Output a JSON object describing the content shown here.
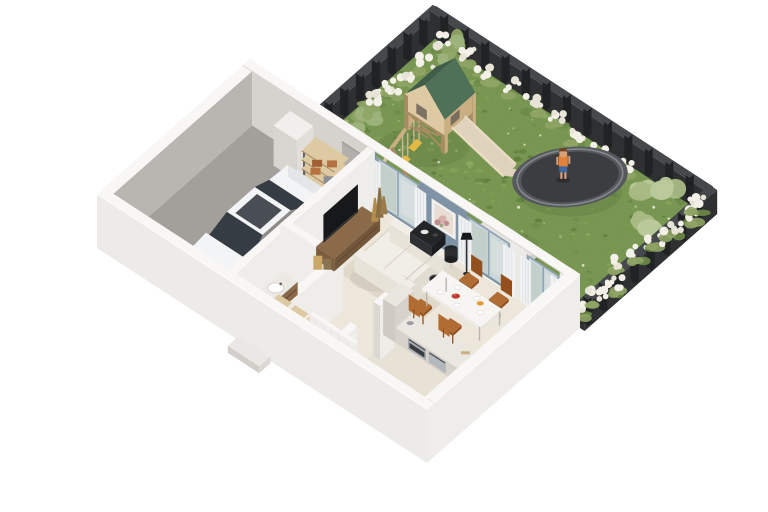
{
  "scene": {
    "type": "isometric-3d-floor-plan",
    "house": {
      "rooms": [
        "garage",
        "bathroom",
        "hallway",
        "staircase",
        "kitchen",
        "dining-area",
        "living-room"
      ],
      "objects": [
        "white-car",
        "storage-shelf",
        "tall-cabinet",
        "garage-door",
        "entry-door",
        "vanity-sink",
        "toilet",
        "closet-shelves",
        "stairs",
        "kitchen-counter",
        "oven",
        "dishwasher",
        "cooktop",
        "dining-table",
        "four-wooden-chairs",
        "tv-stand",
        "tv",
        "sofa",
        "coffee-table",
        "side-table",
        "floor-lamp",
        "robot-vacuum",
        "rug",
        "decor-vases",
        "framed-artwork",
        "curtains",
        "sliding-glass-doors",
        "porch-step"
      ]
    },
    "garden": {
      "objects": [
        "lawn",
        "dark-fence",
        "white-flower-hedges",
        "olive-grasses",
        "light-green-bushes",
        "wooden-swing-set",
        "green-gable-roof",
        "slide",
        "two-yellow-swings",
        "trampoline",
        "child-on-trampoline",
        "concrete-bench-set"
      ]
    }
  },
  "labels": {
    "plot": "3D cutaway floor plan of a single family house with garden",
    "garden_lawn": "green lawn",
    "fence_nw": "dark garden fence rear left",
    "fence_ne": "dark garden fence rear right",
    "fence_se": "dark garden fence front right",
    "flowers": "white flowering hedges along fence",
    "swing_set": "wooden play tower with green roof, slide and swings",
    "trampoline": "round dark trampoline",
    "child": "child standing on trampoline",
    "garden_bench": "concrete garden bench set",
    "floors": "house floors",
    "wall_nw": "rear left exterior wall",
    "wall_ne": "window wall facing garden with blue accent panel",
    "partitions": "interior partition walls",
    "garage_storage": "tall cabinet and storage rack in garage",
    "car": "white coupe parked in garage",
    "bathroom": "bathroom with wooden vanity and toilet",
    "hallway": "hallway closets",
    "stairs": "wooden staircase",
    "kitchen": "kitchen counters with steel appliances",
    "dining": "white dining table with four wooden chairs",
    "living": "living room with white sofa and TV wall",
    "wall_se": "front right exterior wall",
    "wall_sw": "front left exterior wall with garage and entry doors",
    "porch": "entry porch step"
  },
  "colors": {
    "background": "#ffffff",
    "grassBase": "#71904a",
    "grassLight": "#85a457",
    "grassDark": "#5b793a",
    "grassMoss": "#93ad62",
    "flowerWhite": "#f3f1e7",
    "flowerCream": "#e7e4d7",
    "bushGreen": "#8fa465",
    "bushLight": "#bac99b",
    "bushOlive": "#9db37c",
    "foliageDark": "#6d8a49",
    "soil": "#6f5a3c",
    "fenceDark": "#2e3032",
    "fenceTop": "#46494c",
    "fencePost": "#202224",
    "woodLight": "#ddc9a2",
    "wood": "#c9af82",
    "woodDark": "#a78c62",
    "roofGreen": "#4e7158",
    "roofGreenDark": "#3f5d49",
    "slideBeige": "#e0d3bc",
    "slideEdge": "#eadbc4",
    "swingYellow": "#e3b945",
    "trampMat": "#3b3d40",
    "trampPad": "#55585c",
    "trampRim": "#84888c",
    "trampLeg": "#292b2d",
    "childSkin": "#d9a078",
    "childShirt": "#e2813b",
    "childShorts": "#41699f",
    "childHair": "#6f4526",
    "concrete": "#e4e2dc",
    "concreteShade": "#cfcdc6",
    "wallTop": "#f8f7f5",
    "wallLight": "#efedea",
    "wallShade": "#dbd8d3",
    "wallGray": "#b9b5b0",
    "wallMid": "#d6d3ce",
    "accentBlue": "#7e93a6",
    "frameBlue": "#8fa3b3",
    "glass": "#ccd7da",
    "glassGreen": "#b9c9bd",
    "curtain": "#f2f3f4",
    "curtainShade": "#dde0e2",
    "floorMain": "#ece6db",
    "floorWarm": "#e7e0d3",
    "rug": "#e0d9ca",
    "garageFloor": "#a3a09c",
    "garageFloorDark": "#8b8884",
    "bathTile": "#b7babb",
    "bathTileLine": "#a6a9aa",
    "doorDark": "#323437",
    "doorSlat": "#44474b",
    "carWhite": "#f3f4f5",
    "carShade": "#dddfe2",
    "carGlass": "#363c44",
    "carDark": "#222528",
    "carHub": "#787c80",
    "carGrille": "#2e3134",
    "tvBlack": "#17181a",
    "consoleWood": "#8a6a48",
    "consoleWoodDark": "#73573a",
    "sofa": "#f1eee7",
    "sofaShade": "#e1dcd1",
    "tableBlack": "#232527",
    "tableWhite": "#f6f5f2",
    "chairWood": "#b06c33",
    "chairWoodDark": "#934f1d",
    "counter": "#eae6e0",
    "counterSide": "#d7d3cc",
    "steel": "#a9aeb3",
    "steelDark": "#53575c",
    "cooktop": "#2b2d2f",
    "stairWood": "#e6d7ba",
    "vaseBrass": "#b08d4f",
    "vaseBronze": "#8a6f45",
    "plant": "#7da35b",
    "plantDark": "#5f8140",
    "foodRed": "#c23a2c",
    "foodOrange": "#e29a3a",
    "artPink": "#d8b0a8",
    "artPink2": "#c08b8c",
    "artBg": "#e9ded6",
    "shadow": "rgba(0,0,0,0.13)"
  }
}
